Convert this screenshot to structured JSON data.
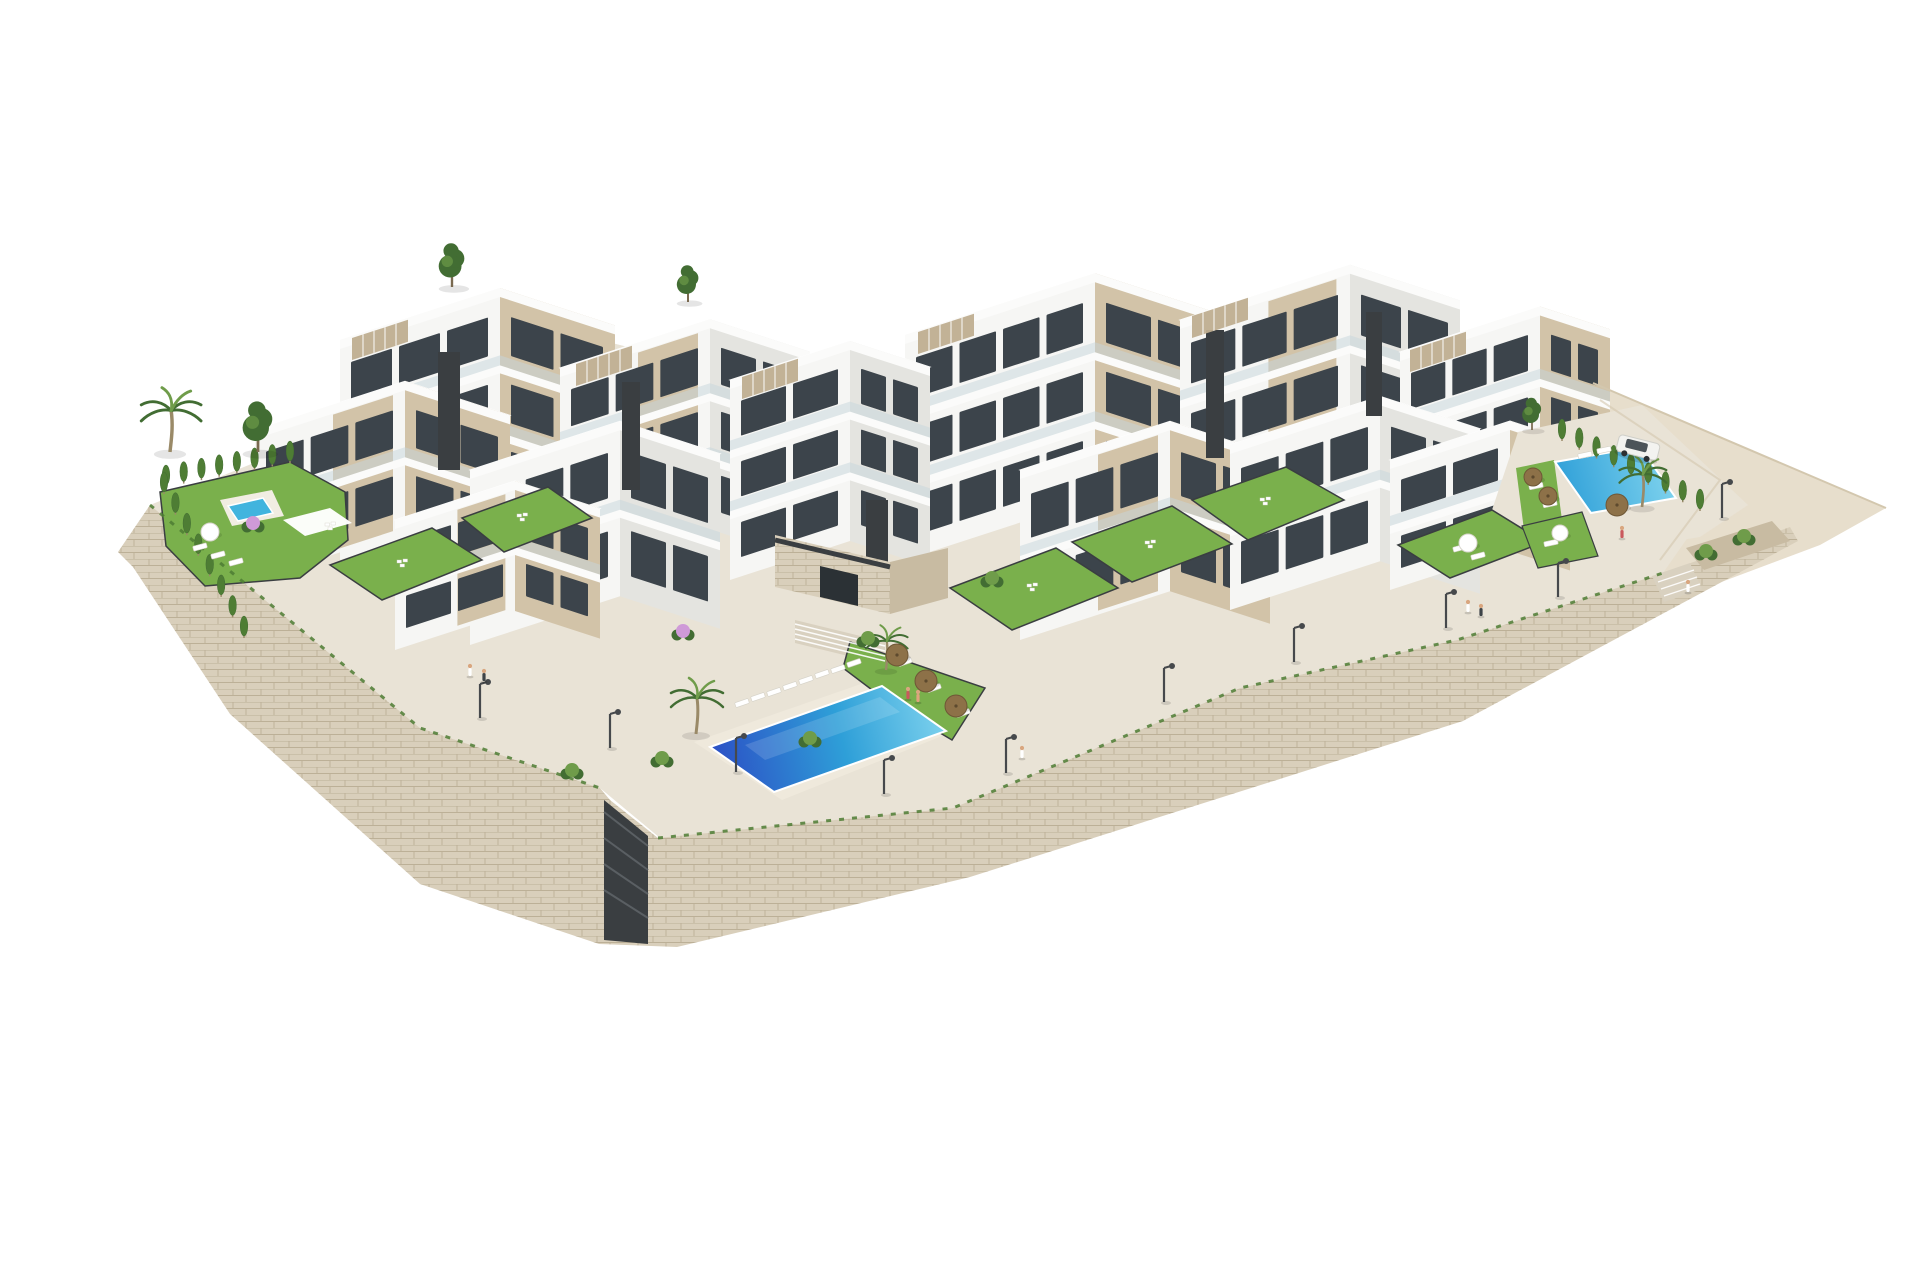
{
  "palette": {
    "bg": "#ffffff",
    "white_face": "#f6f6f4",
    "shade_face": "#e4e4e0",
    "beige": "#d2c3a8",
    "beige_dark": "#bfae90",
    "roof": "#f0f1ed",
    "charcoal": "#3a3e41",
    "window": "#3c444b",
    "glass": "#c6d6dc",
    "wall_stone": "#d9cfbb",
    "wall_stone_dark": "#c8bba2",
    "wall_joint": "#b3a58a",
    "paving": "#e9e3d6",
    "paving_dark": "#d9d1c0",
    "terrain": "#e7decc",
    "terrain_edge": "#d3c7ae",
    "lawn": "#7ab04c",
    "hedge": "#4e7d34",
    "tree_dark": "#426d33",
    "tree_light": "#6f9c4a",
    "pool_deep": "#2c4fc5",
    "pool_mid": "#2e9fd8",
    "pool_light": "#7fd3ee",
    "pool_small": "#41b4de",
    "umbrella": "#8d7148",
    "lamp": "#46494c",
    "car": "#f3f3f0",
    "skin": "#d9a67f",
    "trunk": "#9a8a68",
    "pink": "#cf9ad8"
  },
  "scene": {
    "back_polys": [
      {
        "n": "terrain-slope",
        "p": "1593,383 1886,508 1820,545 1700,590 1560,640 1488,600 1505,505 1545,440",
        "f": "terrain"
      },
      {
        "n": "site-paving-plateau",
        "p": "150,505 360,420 600,340 760,380 905,420 1100,470 1310,515 1440,470 1560,425 1700,520 1663,573 1457,640 1240,688 953,808 660,838 600,788 420,728",
        "f": "paving"
      },
      {
        "n": "stone-retaining-wall",
        "p": "150,505 420,728 600,788 610,800 658,838 953,808 1240,688 1457,640 1663,573 1790,527 1798,541 1463,721 970,877 677,947 599,944 420,884 230,714 133,567 118,552",
        "f": "stonePat",
        "grad": "stonePat"
      },
      {
        "n": "garage-door",
        "p": "604,800 648,836 648,944 604,940",
        "f": "charcoal"
      }
    ],
    "buildings": [
      {
        "x": 340,
        "y": 340,
        "wB": 160,
        "wA": 115,
        "h": 220,
        "fB": "white_face",
        "fA": "beige"
      },
      {
        "x": 560,
        "y": 368,
        "wB": 150,
        "wA": 100,
        "h": 210,
        "fB": "white_face",
        "fA": "shade_face",
        "pn": 1
      },
      {
        "x": 905,
        "y": 335,
        "wB": 190,
        "wA": 120,
        "h": 225,
        "fB": "white_face",
        "fA": "beige"
      },
      {
        "x": 1180,
        "y": 320,
        "wB": 170,
        "wA": 110,
        "h": 230,
        "fB": "white_face",
        "fA": "shade_face",
        "pn": 1
      },
      {
        "x": 1400,
        "y": 352,
        "wB": 140,
        "wA": 70,
        "h": 205,
        "fB": "white_face",
        "fA": "beige"
      },
      {
        "x": 730,
        "y": 380,
        "wB": 120,
        "wA": 80,
        "h": 200,
        "fB": "white_face",
        "fA": "shade_face"
      },
      {
        "x": 255,
        "y": 430,
        "wB": 150,
        "wA": 105,
        "h": 150,
        "fB": "white_face",
        "fA": "beige",
        "pn": 1
      },
      {
        "x": 470,
        "y": 470,
        "wB": 150,
        "wA": 100,
        "h": 175,
        "fB": "white_face",
        "fA": "shade_face"
      },
      {
        "x": 1020,
        "y": 470,
        "wB": 150,
        "wA": 100,
        "h": 170,
        "fB": "white_face",
        "fA": "beige",
        "pn": 1
      },
      {
        "x": 1230,
        "y": 445,
        "wB": 150,
        "wA": 100,
        "h": 165,
        "fB": "white_face",
        "fA": "shade_face"
      },
      {
        "x": 1390,
        "y": 460,
        "wB": 120,
        "wA": 60,
        "h": 130,
        "fB": "white_face",
        "fA": "beige"
      },
      {
        "x": 395,
        "y": 520,
        "wB": 120,
        "wA": 85,
        "h": 130,
        "fB": "white_face",
        "fA": "beige",
        "pn": 1
      }
    ],
    "cores": [
      {
        "x": 438,
        "y": 352,
        "w": 22,
        "h": 118
      },
      {
        "x": 622,
        "y": 382,
        "w": 18,
        "h": 108
      },
      {
        "x": 1206,
        "y": 330,
        "w": 18,
        "h": 128
      },
      {
        "x": 1366,
        "y": 312,
        "w": 16,
        "h": 104
      },
      {
        "x": 866,
        "y": 500,
        "w": 22,
        "h": 66
      }
    ],
    "pergolas": [
      {
        "x": 352,
        "y": 338
      },
      {
        "x": 576,
        "y": 364
      },
      {
        "x": 742,
        "y": 377
      },
      {
        "x": 918,
        "y": 332
      },
      {
        "x": 1192,
        "y": 316
      },
      {
        "x": 1410,
        "y": 350
      }
    ],
    "front_polys": [
      {
        "n": "driveway-terrace",
        "p": "1518,432 1642,405 1748,505 1700,537 1560,560 1488,522",
        "f": "paving"
      },
      {
        "n": "left-garden-lawn",
        "p": "160,492 290,462 345,492 348,540 300,578 205,586 166,546",
        "f": "lawn",
        "s": "charcoal",
        "sw": 1.5
      },
      {
        "n": "left-pool-deck",
        "p": "220,500 272,490 284,516 232,526",
        "f": "#f1ede2"
      },
      {
        "n": "left-garden-pool",
        "p": "228,506 263,498 273,513 238,521",
        "f": "pool_small",
        "s": "#ffffff",
        "sw": 1.5
      },
      {
        "n": "left-garden-pergola",
        "p": "283,520 330,508 352,523 305,536",
        "f": "#ffffff",
        "o": 0.97
      },
      {
        "n": "villa-garden-lawn",
        "p": "330,565 432,528 482,560 382,600",
        "f": "lawn",
        "s": "charcoal",
        "sw": 1.5
      },
      {
        "n": "villa-garden-lawn",
        "p": "462,518 548,487 592,518 504,552",
        "f": "lawn",
        "s": "charcoal",
        "sw": 1.5
      },
      {
        "n": "clubhouse-front",
        "p": "775,535 890,562 890,614 775,587",
        "f": "stonePat",
        "grad": "stonePat"
      },
      {
        "n": "clubhouse-side",
        "p": "890,562 948,548 948,598 890,614",
        "f": "wall_stone_dark"
      },
      {
        "n": "clubhouse-door",
        "p": "820,566 858,575 858,606 820,597",
        "f": "#2b3135"
      },
      {
        "n": "stairs-to-pool",
        "p": "795,620 885,642 885,665 795,643",
        "f": "paving_dark"
      },
      {
        "n": "pool-deck",
        "p": "694,742 884,676 962,728 782,800",
        "f": "#efe9dc"
      },
      {
        "n": "pool-lawn",
        "p": "850,642 985,688 952,740 888,702 843,668",
        "f": "lawn",
        "s": "charcoal",
        "sw": 1.5
      },
      {
        "n": "garden-lawn",
        "p": "950,588 1056,548 1118,588 1012,630",
        "f": "lawn",
        "s": "charcoal",
        "sw": 1.5
      },
      {
        "n": "garden-lawn",
        "p": "1072,542 1172,506 1232,544 1132,582",
        "f": "lawn",
        "s": "charcoal",
        "sw": 1.5
      },
      {
        "n": "garden-lawn",
        "p": "1192,500 1286,467 1344,500 1248,540",
        "f": "lawn",
        "s": "charcoal",
        "sw": 1.5
      },
      {
        "n": "garden-lawn",
        "p": "1398,545 1492,510 1544,542 1450,578",
        "f": "lawn",
        "s": "charcoal",
        "sw": 1.5
      },
      {
        "n": "right-lawn-strip",
        "p": "1516,468 1554,460 1562,520 1524,530",
        "f": "lawn"
      },
      {
        "n": "right-lawn-lower",
        "p": "1522,526 1582,512 1598,556 1538,568",
        "f": "lawn",
        "s": "charcoal",
        "sw": 1.2
      },
      {
        "n": "main-pool",
        "p": "710,747 882,686 946,731 774,792",
        "grad": "poolGrad",
        "s": "#ffffff",
        "sw": 2
      },
      {
        "n": "main-pool-sparkle",
        "p": "745,745 880,697 900,712 765,760",
        "f": "#ffffff",
        "o": 0.14
      },
      {
        "n": "right-pool",
        "p": "1555,462 1640,447 1676,498 1591,513",
        "grad": "rightPoolGrad",
        "s": "#ffffff",
        "sw": 2
      },
      {
        "n": "promenade-stairs",
        "p": "1652,576 1690,563 1702,589 1664,602",
        "f": "paving_dark"
      },
      {
        "n": "promenade-planter",
        "p": "1686,548 1772,521 1790,541 1704,570",
        "f": "wall_stone_dark"
      }
    ],
    "strokes": [
      {
        "n": "clubhouse-canopy",
        "d": "M775,540 L890,567",
        "s": "charcoal",
        "w": 5
      },
      {
        "n": "stair-step",
        "d": "M795,624 L885,646",
        "s": "#ffffff",
        "w": 1.5,
        "o": 0.9
      },
      {
        "n": "stair-step",
        "d": "M795,629 L885,651",
        "s": "#ffffff",
        "w": 1.5,
        "o": 0.9
      },
      {
        "n": "stair-step",
        "d": "M795,634 L885,656",
        "s": "#ffffff",
        "w": 1.5,
        "o": 0.9
      },
      {
        "n": "stair-step",
        "d": "M795,639 L885,661",
        "s": "#ffffff",
        "w": 1.5,
        "o": 0.9
      },
      {
        "n": "stair-step",
        "d": "M1658,582 L1694,570",
        "s": "#ffffff",
        "w": 1.4,
        "o": 0.9
      },
      {
        "n": "stair-step",
        "d": "M1661,589 L1697,577",
        "s": "#ffffff",
        "w": 1.4,
        "o": 0.9
      },
      {
        "n": "stair-step",
        "d": "M1664,596 L1700,584",
        "s": "#ffffff",
        "w": 1.4,
        "o": 0.9
      },
      {
        "n": "garage-slat",
        "d": "M604,812 L648,846",
        "s": "#5a5f63",
        "w": 2
      },
      {
        "n": "garage-slat",
        "d": "M604,838 L648,870",
        "s": "#5a5f63",
        "w": 2
      },
      {
        "n": "garage-slat",
        "d": "M604,864 L648,894",
        "s": "#5a5f63",
        "w": 2
      },
      {
        "n": "garage-slat",
        "d": "M604,890 L648,918",
        "s": "#5a5f63",
        "w": 2
      },
      {
        "n": "terrain-ridge",
        "d": "M1593,383 L1886,508",
        "s": "terrain_edge",
        "w": 2
      },
      {
        "n": "terrain-path",
        "d": "M1600,400 L1720,480 L1660,560",
        "s": "terrain_edge",
        "w": 2,
        "o": 0.6
      },
      {
        "n": "wall-grass-tufts",
        "d": "M150,505 L420,728 L600,788",
        "s": "hedge",
        "w": 3,
        "dash": "5 8",
        "o": 0.85
      },
      {
        "n": "wall-grass-tufts",
        "d": "M658,838 L953,808 L1240,688 L1457,640 L1663,573",
        "s": "hedge",
        "w": 3,
        "dash": "5 8",
        "o": 0.85
      }
    ],
    "hedges": [
      {
        "x1": 166,
        "y1": 487,
        "x2": 290,
        "y2": 463,
        "n": 8
      },
      {
        "x1": 164,
        "y1": 494,
        "x2": 244,
        "y2": 638,
        "n": 8
      },
      {
        "x1": 1562,
        "y1": 441,
        "x2": 1700,
        "y2": 511,
        "n": 9
      }
    ],
    "pines": [
      {
        "x": 258,
        "y": 452,
        "s": 1.1
      },
      {
        "x": 452,
        "y": 287,
        "s": 0.95
      },
      {
        "x": 688,
        "y": 302,
        "s": 0.8
      },
      {
        "x": 1532,
        "y": 430,
        "s": 0.7
      }
    ],
    "palms": [
      {
        "x": 170,
        "y": 452,
        "s": 1.15
      },
      {
        "x": 696,
        "y": 734,
        "s": 1.0
      },
      {
        "x": 886,
        "y": 670,
        "s": 0.8
      },
      {
        "x": 1642,
        "y": 507,
        "s": 0.9
      }
    ],
    "bushes": [
      {
        "x": 662,
        "y": 760
      },
      {
        "x": 810,
        "y": 740
      },
      {
        "x": 868,
        "y": 640
      },
      {
        "x": 992,
        "y": 580
      },
      {
        "x": 1706,
        "y": 553
      },
      {
        "x": 1744,
        "y": 538
      },
      {
        "x": 572,
        "y": 772
      },
      {
        "x": 683,
        "y": 633,
        "c": "pink"
      },
      {
        "x": 253,
        "y": 525,
        "c": "pink"
      }
    ],
    "loungers": [
      {
        "x": 742,
        "y": 703,
        "a": -19
      },
      {
        "x": 758,
        "y": 697,
        "a": -19
      },
      {
        "x": 774,
        "y": 692,
        "a": -19
      },
      {
        "x": 790,
        "y": 686,
        "a": -19
      },
      {
        "x": 806,
        "y": 680,
        "a": -19
      },
      {
        "x": 822,
        "y": 674,
        "a": -19
      },
      {
        "x": 838,
        "y": 669,
        "a": -19
      },
      {
        "x": 854,
        "y": 663,
        "a": -19
      },
      {
        "x": 905,
        "y": 662,
        "a": -19
      },
      {
        "x": 934,
        "y": 688,
        "a": -19
      },
      {
        "x": 963,
        "y": 713,
        "a": -19
      },
      {
        "x": 200,
        "y": 547,
        "a": -15
      },
      {
        "x": 218,
        "y": 555,
        "a": -15
      },
      {
        "x": 236,
        "y": 562,
        "a": -15
      },
      {
        "x": 1585,
        "y": 455,
        "a": -12
      },
      {
        "x": 1604,
        "y": 450,
        "a": -12
      },
      {
        "x": 1623,
        "y": 446,
        "a": -12
      },
      {
        "x": 1536,
        "y": 486,
        "a": -12
      },
      {
        "x": 1550,
        "y": 504,
        "a": -12
      },
      {
        "x": 1460,
        "y": 548,
        "a": -15
      },
      {
        "x": 1478,
        "y": 556,
        "a": -15
      },
      {
        "x": 1551,
        "y": 543,
        "a": -12
      }
    ],
    "umbrellas": [
      {
        "x": 897,
        "y": 655,
        "r": 11
      },
      {
        "x": 926,
        "y": 681,
        "r": 11
      },
      {
        "x": 956,
        "y": 706,
        "r": 11
      },
      {
        "x": 1533,
        "y": 477,
        "r": 9
      },
      {
        "x": 1548,
        "y": 496,
        "r": 9
      },
      {
        "x": 1617,
        "y": 505,
        "r": 11
      }
    ],
    "parasols": [
      {
        "x": 210,
        "y": 532,
        "r": 9
      },
      {
        "x": 1468,
        "y": 543,
        "r": 9
      },
      {
        "x": 1560,
        "y": 533,
        "r": 8
      }
    ],
    "furniture": [
      {
        "x": 1032,
        "y": 586
      },
      {
        "x": 1150,
        "y": 543
      },
      {
        "x": 1265,
        "y": 500
      },
      {
        "x": 402,
        "y": 562
      },
      {
        "x": 522,
        "y": 516
      },
      {
        "x": 330,
        "y": 525
      }
    ],
    "lamps": [
      {
        "x": 480,
        "y": 718
      },
      {
        "x": 610,
        "y": 748
      },
      {
        "x": 736,
        "y": 772
      },
      {
        "x": 884,
        "y": 794
      },
      {
        "x": 1006,
        "y": 773
      },
      {
        "x": 1164,
        "y": 702
      },
      {
        "x": 1294,
        "y": 662
      },
      {
        "x": 1446,
        "y": 628
      },
      {
        "x": 1558,
        "y": 597
      },
      {
        "x": 1722,
        "y": 518
      }
    ],
    "people": [
      {
        "x": 470,
        "y": 676,
        "c": "#ffffff"
      },
      {
        "x": 484,
        "y": 681,
        "c": "#3d4347"
      },
      {
        "x": 1022,
        "y": 758,
        "c": "#ffffff"
      },
      {
        "x": 1468,
        "y": 612,
        "c": "#ffffff"
      },
      {
        "x": 1481,
        "y": 616,
        "c": "#3d4347"
      },
      {
        "x": 1688,
        "y": 592,
        "c": "#ffffff"
      },
      {
        "x": 1622,
        "y": 538,
        "c": "#c9595d"
      },
      {
        "x": 908,
        "y": 699,
        "c": "#c9595d"
      },
      {
        "x": 918,
        "y": 702,
        "c": "#e0a37e"
      }
    ],
    "car": {
      "x": 1638,
      "y": 448,
      "a": 14
    }
  }
}
